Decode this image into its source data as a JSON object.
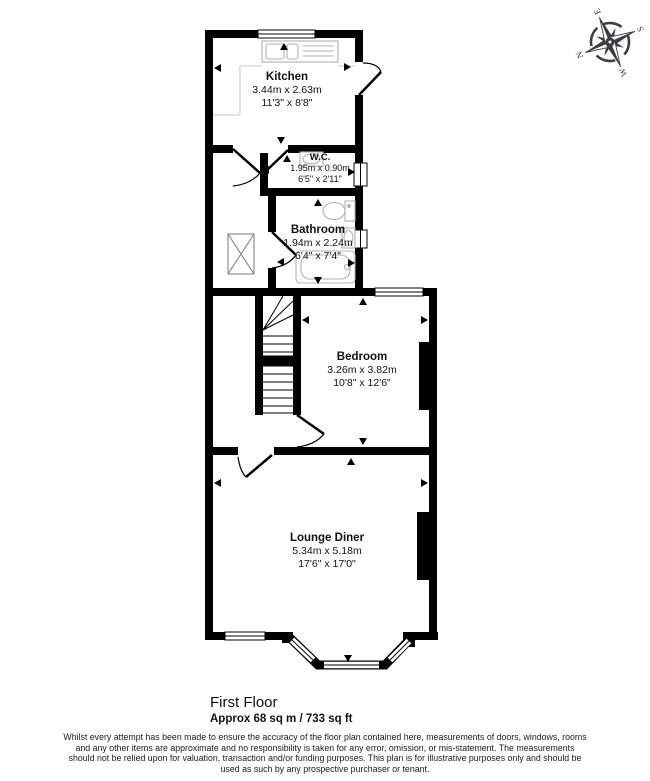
{
  "rooms": {
    "kitchen": {
      "name": "Kitchen",
      "metric": "3.44m x 2.63m",
      "imperial": "11'3\" x 8'8\""
    },
    "wc": {
      "name": "W.C.",
      "metric": "1.95m x 0.90m",
      "imperial": "6'5\" x 2'11\""
    },
    "bathroom": {
      "name": "Bathroom",
      "metric": "1.94m x 2.24m",
      "imperial": "6'4\" x 7'4\""
    },
    "bedroom": {
      "name": "Bedroom",
      "metric": "3.26m x 3.82m",
      "imperial": "10'8\" x 12'6\""
    },
    "lounge": {
      "name": "Lounge Diner",
      "metric": "5.34m x 5.18m",
      "imperial": "17'6\" x 17'0\""
    }
  },
  "compass": {
    "n": "N",
    "e": "E",
    "s": "S",
    "w": "W"
  },
  "footer": {
    "floor_title": "First Floor",
    "area": "Approx 68 sq m / 733 sq ft",
    "disclaimer": "Whilst every attempt has been made to ensure the accuracy of the floor plan contained here, measurements of doors, windows, rooms and any other items are approximate and no responsibility is taken for any error, omission, or mis-statement. The measurements should not be relied upon for valuation, transaction and/or funding purposes. This plan is for illustrative purposes only and should be used as such by any prospective purchaser or tenant."
  },
  "colors": {
    "wall": "#000000",
    "fixture": "#b0b0b0",
    "counter": "#c8c8c8",
    "compass": "#3c3c46"
  }
}
